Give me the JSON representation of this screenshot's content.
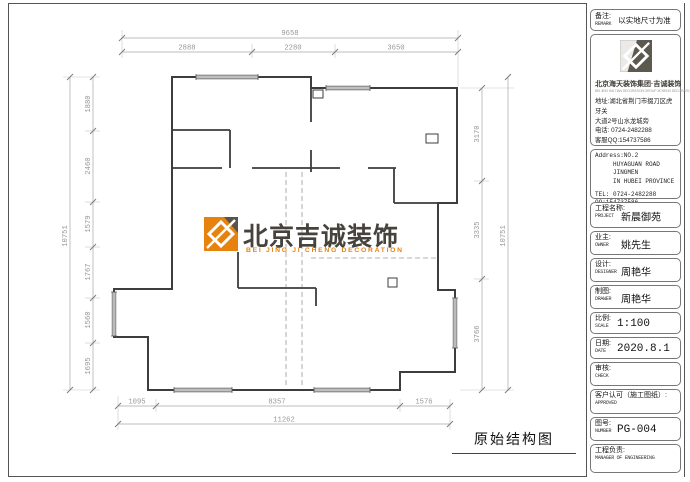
{
  "sheet": {
    "drawing_label": "原始结构图"
  },
  "watermark": {
    "name": "北京吉诚装饰",
    "tagline": "BEI JING JI CHENG DECORATION",
    "orange": "#e8820e",
    "dark": "#57544c"
  },
  "dims": {
    "top_total": "9658",
    "top_segments": [
      "2888",
      "2280",
      "3650"
    ],
    "left_total": "10751",
    "left_segments": [
      "1880",
      "2460",
      "1579",
      "1767",
      "1560",
      "1695"
    ],
    "right_total": "10751",
    "right_segments": [
      "3170",
      "3335",
      "3766"
    ],
    "bottom_segments": [
      "1095",
      "8357",
      "1576"
    ],
    "bottom_total": "11262"
  },
  "titleblock": {
    "remark_label": "备注:",
    "remark_label_en": "REMARK",
    "remark_value": "以实地尺寸为准",
    "company": "北京海天装饰集团·吉诚装饰",
    "company_en": "BEI JING HAI TIAN DECORATION GROUP JICHENG DECORATION",
    "address_cn_1": "地址:湖北省荆门市掇刀区虎牙关",
    "address_cn_2": "大道2号山水龙城旁",
    "phone_cn": "电话: 0724-2482288",
    "qq_cn": "客服QQ:154737586",
    "address_en_1": "Address:NO.2",
    "address_en_2": "HUYAGUAN ROAD JINGMEN",
    "address_en_3": "IN HUBEI PROVINCE",
    "tel_en": "TEL: 0724-2482288",
    "qq_en": "QQ:154737586",
    "fields": [
      {
        "label": "工程名称:",
        "label_en": "PROJECT",
        "value": "新晨御苑"
      },
      {
        "label": "业主:",
        "label_en": "OWNER",
        "value": "姚先生"
      },
      {
        "label": "设计:",
        "label_en": "DESIGNER",
        "value": "周艳华"
      },
      {
        "label": "制图:",
        "label_en": "DRAWER",
        "value": "周艳华"
      },
      {
        "label": "比例:",
        "label_en": "SCALE",
        "value": "1:100"
      },
      {
        "label": "日期:",
        "label_en": "DATE",
        "value": "2020.8.1"
      },
      {
        "label": "审核:",
        "label_en": "CHECK",
        "value": ""
      },
      {
        "label": "客户认可（施工图纸）:",
        "label_en": "APPROVED",
        "value": ""
      },
      {
        "label": "图号:",
        "label_en": "NUMBER",
        "value": "PG-004"
      },
      {
        "label": "工程负责:",
        "label_en": "MANAGER OF ENGINEERING",
        "value": ""
      }
    ]
  }
}
